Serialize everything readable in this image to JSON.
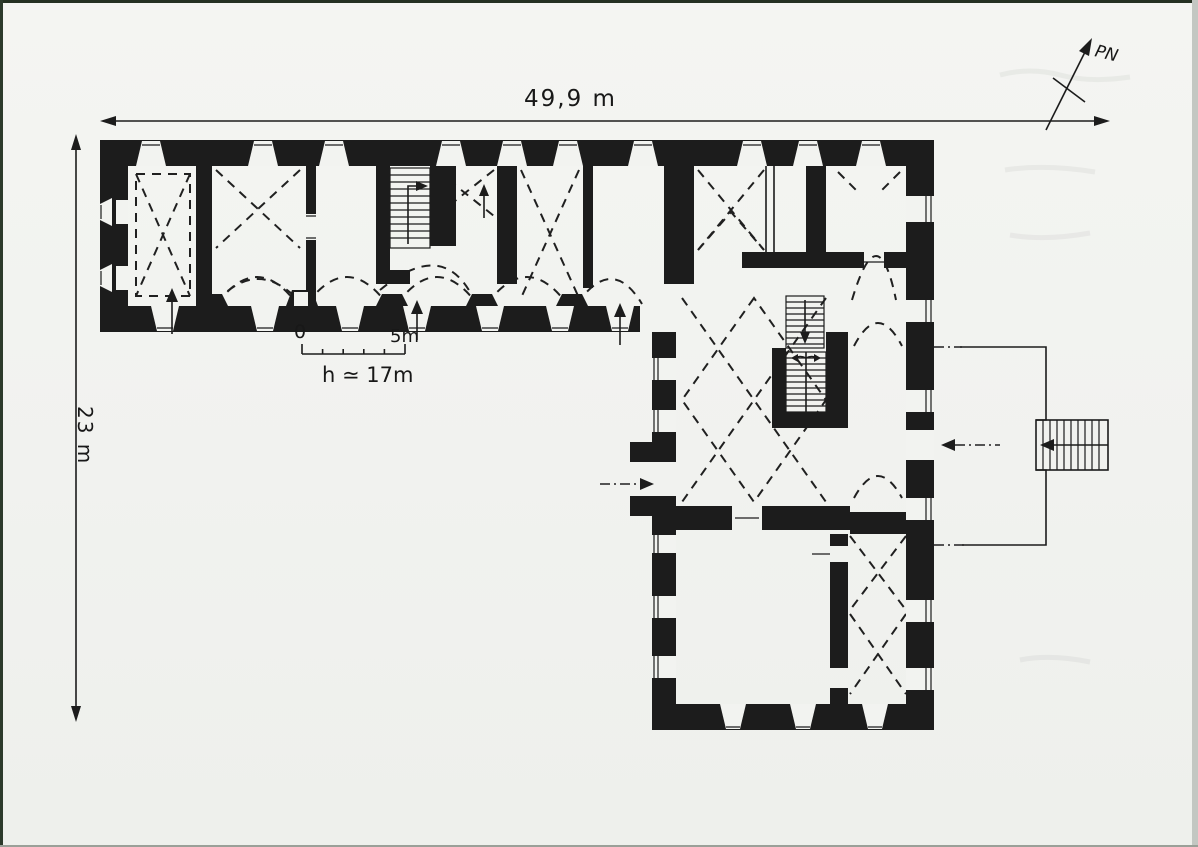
{
  "drawing": {
    "kind": "scanned architectural ground floor plan, L-shaped building",
    "annotations": {
      "width_dimension": "49,9 m",
      "height_dimension": "23 m",
      "scale_zero": "0",
      "scale_five": "5m",
      "height_note": "h ≃ 17m",
      "north_label": "PN"
    },
    "colors": {
      "ink": "#1c1c1c",
      "paper": "#f2f3f0",
      "scan_edge_dark": "#243122",
      "scan_edge_gray": "#c3c7c2"
    },
    "features": {
      "dimension_top": "overall length dimension line with end arrows",
      "dimension_left": "overall depth dimension line with end arrows",
      "north_arrow": "hand-drawn north arrow marked PN, upper right",
      "scale_bar": "graphic bar scale 0–5 m with metre ticks",
      "stairs": [
        "straight internal stair west wing",
        "double-flight internal stair at junction",
        "external stair on east terrace"
      ],
      "entry_arrows": [
        "three from south into west wing",
        "one from west porch",
        "one from east terrace"
      ],
      "vault_lines": "dashed cross-vault and arch lines in rooms"
    }
  }
}
